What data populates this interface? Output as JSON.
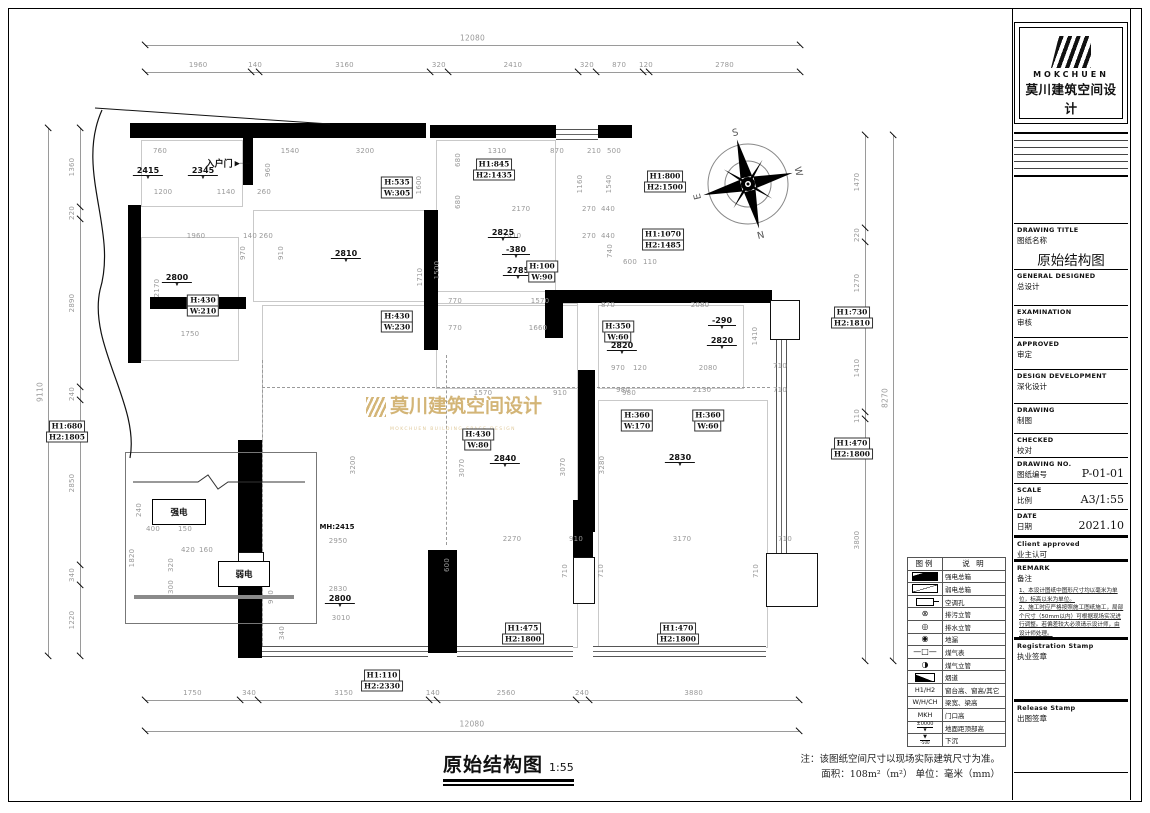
{
  "title_block": {
    "logo_en": "MOKCHUEN",
    "logo_cn": "莫川建筑空间设计",
    "fields": [
      {
        "en": "DRAWING TITLE",
        "cn": "图纸名称",
        "value": "原始结构图",
        "big": true
      },
      {
        "en": "GENERAL  DESIGNED",
        "cn": "总设计",
        "value": ""
      },
      {
        "en": "EXAMINATION",
        "cn": "审核",
        "value": ""
      },
      {
        "en": "APPROVED",
        "cn": "审定",
        "value": ""
      },
      {
        "en": "DESIGN DEVELOPMENT",
        "cn": "深化设计",
        "value": ""
      },
      {
        "en": "DRAWING",
        "cn": "制图",
        "value": ""
      },
      {
        "en": "CHECKED",
        "cn": "校对",
        "value": ""
      },
      {
        "en": "DRAWING NO.",
        "cn": "图纸编号",
        "value": "P-01-01"
      },
      {
        "en": "SCALE",
        "cn": "比例",
        "value": "A3/1:55"
      },
      {
        "en": "DATE",
        "cn": "日期",
        "value": "2021.10"
      },
      {
        "en": "Client approved",
        "cn": "业主认可",
        "value": "",
        "thick": true
      }
    ],
    "remark": {
      "en": "REMARK",
      "cn": "备注",
      "notes": [
        "1、本设计图纸中图形尺寸均以毫米为单位，标高以米为单位。",
        "2、施工时应严格按照施工图纸施工，局部个尺寸（50mm以内）可根据现场实况进行调整。若偏差较大必须请示设计师，由设计师处理。"
      ]
    },
    "stamps": [
      {
        "en": "Registration Stamp",
        "cn": "执业签章"
      },
      {
        "en": "Release Stamp",
        "cn": "出图签章"
      }
    ]
  },
  "legend": {
    "headers": [
      "图例",
      "说  明"
    ],
    "rows": [
      {
        "icon": "solid-bar",
        "label": "强电总箱"
      },
      {
        "icon": "diag-bar",
        "label": "弱电总箱"
      },
      {
        "icon": "kt",
        "label": "空调孔"
      },
      {
        "icon": "circle-cross",
        "sym": "⊗",
        "label": "排污立管"
      },
      {
        "icon": "circle-double",
        "sym": "◎",
        "label": "排水立管"
      },
      {
        "icon": "circle-filled",
        "sym": "◉",
        "label": "地漏"
      },
      {
        "icon": "gas-meter",
        "sym": "—□—",
        "label": "煤气表"
      },
      {
        "icon": "circle-half",
        "sym": "◑",
        "label": "煤气立管"
      },
      {
        "icon": "flue",
        "label": "烟道"
      },
      {
        "icon": "text",
        "icon_text": "H1/H2",
        "label": "窗台高、窗高/其它"
      },
      {
        "icon": "text",
        "icon_text": "W/H/CH",
        "label": "梁宽、梁高"
      },
      {
        "icon": "text",
        "icon_text": "MKH",
        "label": "门口高"
      },
      {
        "icon": "elev",
        "icon_text": "±0000",
        "label": "地面距顶部高"
      },
      {
        "icon": "sunk",
        "icon_text": "-500",
        "label": "下沉"
      }
    ]
  },
  "footer": {
    "title": "原始结构图",
    "scale": "1:55",
    "note1": "注：该图纸空间尺寸以现场实际建筑尺寸为准。",
    "note2": "面积：108m²（m²） 单位：毫米（mm）"
  },
  "plan": {
    "entry_label": "入户门",
    "mh_label": "MH:2415",
    "electric": {
      "strong": "强电",
      "weak": "弱电"
    },
    "watermark": {
      "cn": "莫川建筑空间设计",
      "en": "MOKCHUEN BUILDING SPACE DESIGN"
    },
    "compass": {
      "letters": [
        "S",
        "W",
        "N",
        "E"
      ]
    },
    "totals": {
      "top": "12080",
      "bottom": "12080",
      "left": "9110",
      "right": "8270"
    },
    "chains": {
      "top": {
        "x0": 145,
        "y": 72,
        "scale": 0.05422,
        "values": [
          1960,
          140,
          3160,
          320,
          2410,
          320,
          870,
          120,
          2780
        ]
      },
      "bottom": {
        "x0": 145,
        "y": 700,
        "scale": 0.05422,
        "values": [
          1750,
          340,
          3150,
          140,
          2560,
          240,
          3880
        ]
      },
      "left": {
        "y0": 128,
        "x": 80,
        "scale": 0.05785,
        "values": [
          1360,
          220,
          2890,
          240,
          2850,
          340,
          1220
        ]
      },
      "right": {
        "y0": 135,
        "x": 865,
        "scale": 0.06348,
        "values": [
          1470,
          220,
          1270,
          1410,
          110,
          3800
        ]
      }
    },
    "dim_labels": [
      {
        "t": "760",
        "x": 160,
        "y": 151
      },
      {
        "t": "1540",
        "x": 290,
        "y": 151
      },
      {
        "t": "3200",
        "x": 365,
        "y": 151
      },
      {
        "t": "1310",
        "x": 497,
        "y": 151
      },
      {
        "t": "870",
        "x": 557,
        "y": 151
      },
      {
        "t": "210",
        "x": 594,
        "y": 151
      },
      {
        "t": "500",
        "x": 614,
        "y": 151
      },
      {
        "t": "1200",
        "x": 163,
        "y": 192
      },
      {
        "t": "1140",
        "x": 226,
        "y": 192
      },
      {
        "t": "260",
        "x": 264,
        "y": 192
      },
      {
        "t": "1960",
        "x": 196,
        "y": 236
      },
      {
        "t": "140",
        "x": 250,
        "y": 236
      },
      {
        "t": "260",
        "x": 266,
        "y": 236
      },
      {
        "t": "2170",
        "x": 157,
        "y": 288,
        "r": 1
      },
      {
        "t": "1750",
        "x": 190,
        "y": 334
      },
      {
        "t": "960",
        "x": 268,
        "y": 170,
        "r": 1
      },
      {
        "t": "970",
        "x": 243,
        "y": 253,
        "r": 1
      },
      {
        "t": "910",
        "x": 281,
        "y": 253,
        "r": 1
      },
      {
        "t": "1600",
        "x": 419,
        "y": 185,
        "r": 1
      },
      {
        "t": "1710",
        "x": 420,
        "y": 277,
        "r": 1
      },
      {
        "t": "680",
        "x": 458,
        "y": 160,
        "r": 1
      },
      {
        "t": "680",
        "x": 458,
        "y": 202,
        "r": 1
      },
      {
        "t": "1160",
        "x": 580,
        "y": 184,
        "r": 1
      },
      {
        "t": "1540",
        "x": 609,
        "y": 184,
        "r": 1
      },
      {
        "t": "2170",
        "x": 521,
        "y": 209
      },
      {
        "t": "270",
        "x": 589,
        "y": 209
      },
      {
        "t": "440",
        "x": 608,
        "y": 209
      },
      {
        "t": "2410",
        "x": 512,
        "y": 236
      },
      {
        "t": "270",
        "x": 589,
        "y": 236
      },
      {
        "t": "440",
        "x": 608,
        "y": 236
      },
      {
        "t": "1500",
        "x": 437,
        "y": 270,
        "r": 1
      },
      {
        "t": "740",
        "x": 610,
        "y": 251,
        "r": 1
      },
      {
        "t": "770",
        "x": 455,
        "y": 301
      },
      {
        "t": "1570",
        "x": 540,
        "y": 301
      },
      {
        "t": "600",
        "x": 630,
        "y": 262
      },
      {
        "t": "110",
        "x": 650,
        "y": 262
      },
      {
        "t": "770",
        "x": 455,
        "y": 328
      },
      {
        "t": "1660",
        "x": 538,
        "y": 328
      },
      {
        "t": "870",
        "x": 608,
        "y": 305
      },
      {
        "t": "2080",
        "x": 700,
        "y": 305
      },
      {
        "t": "1410",
        "x": 755,
        "y": 336,
        "r": 1
      },
      {
        "t": "970",
        "x": 618,
        "y": 368
      },
      {
        "t": "120",
        "x": 640,
        "y": 368
      },
      {
        "t": "2080",
        "x": 708,
        "y": 368
      },
      {
        "t": "710",
        "x": 780,
        "y": 366
      },
      {
        "t": "980",
        "x": 623,
        "y": 390
      },
      {
        "t": "2130",
        "x": 702,
        "y": 390
      },
      {
        "t": "710",
        "x": 780,
        "y": 390
      },
      {
        "t": "1570",
        "x": 483,
        "y": 393
      },
      {
        "t": "910",
        "x": 560,
        "y": 393
      },
      {
        "t": "980",
        "x": 629,
        "y": 393
      },
      {
        "t": "3200",
        "x": 353,
        "y": 465,
        "r": 1
      },
      {
        "t": "3070",
        "x": 462,
        "y": 468,
        "r": 1
      },
      {
        "t": "3070",
        "x": 563,
        "y": 467,
        "r": 1
      },
      {
        "t": "3280",
        "x": 602,
        "y": 465,
        "r": 1
      },
      {
        "t": "2270",
        "x": 512,
        "y": 539
      },
      {
        "t": "910",
        "x": 576,
        "y": 539
      },
      {
        "t": "3170",
        "x": 682,
        "y": 539
      },
      {
        "t": "710",
        "x": 785,
        "y": 539
      },
      {
        "t": "600",
        "x": 447,
        "y": 565,
        "r": 1
      },
      {
        "t": "710",
        "x": 565,
        "y": 571,
        "r": 1
      },
      {
        "t": "710",
        "x": 601,
        "y": 571,
        "r": 1
      },
      {
        "t": "710",
        "x": 756,
        "y": 571,
        "r": 1
      },
      {
        "t": "2830",
        "x": 338,
        "y": 589
      },
      {
        "t": "3010",
        "x": 341,
        "y": 618
      },
      {
        "t": "980",
        "x": 271,
        "y": 597,
        "r": 1
      },
      {
        "t": "340",
        "x": 282,
        "y": 633,
        "r": 1
      },
      {
        "t": "2950",
        "x": 338,
        "y": 541
      },
      {
        "t": "240",
        "x": 139,
        "y": 510,
        "r": 1
      },
      {
        "t": "400",
        "x": 153,
        "y": 529
      },
      {
        "t": "150",
        "x": 185,
        "y": 529
      },
      {
        "t": "1820",
        "x": 132,
        "y": 558,
        "r": 1
      },
      {
        "t": "420",
        "x": 188,
        "y": 550
      },
      {
        "t": "160",
        "x": 206,
        "y": 550
      },
      {
        "t": "320",
        "x": 171,
        "y": 565,
        "r": 1
      },
      {
        "t": "300",
        "x": 171,
        "y": 587,
        "r": 1
      }
    ],
    "markers": [
      {
        "t": "2415",
        "x": 148,
        "y": 173
      },
      {
        "t": "2345",
        "x": 203,
        "y": 173
      },
      {
        "t": "2800",
        "x": 177,
        "y": 280
      },
      {
        "t": "2810",
        "x": 346,
        "y": 256
      },
      {
        "t": "2825",
        "x": 503,
        "y": 235
      },
      {
        "t": "-380",
        "x": 516,
        "y": 252
      },
      {
        "t": "2785",
        "x": 518,
        "y": 273
      },
      {
        "t": "2820",
        "x": 622,
        "y": 348
      },
      {
        "t": "-290",
        "x": 722,
        "y": 323
      },
      {
        "t": "2820",
        "x": 722,
        "y": 343
      },
      {
        "t": "2840",
        "x": 505,
        "y": 461
      },
      {
        "t": "2830",
        "x": 680,
        "y": 460
      },
      {
        "t": "2800",
        "x": 340,
        "y": 601
      }
    ],
    "hw_boxes": [
      {
        "l": [
          "H:535",
          "W:305"
        ],
        "x": 397,
        "y": 188
      },
      {
        "l": [
          "H:430",
          "W:210"
        ],
        "x": 203,
        "y": 306
      },
      {
        "l": [
          "H:430",
          "W:230"
        ],
        "x": 397,
        "y": 322
      },
      {
        "l": [
          "H:100",
          "W:90"
        ],
        "x": 542,
        "y": 272
      },
      {
        "l": [
          "H1:845",
          "H2:1435"
        ],
        "x": 494,
        "y": 170
      },
      {
        "l": [
          "H1:800",
          "H2:1500"
        ],
        "x": 665,
        "y": 182
      },
      {
        "l": [
          "H1:1070",
          "H2:1485"
        ],
        "x": 663,
        "y": 240
      },
      {
        "l": [
          "H:350",
          "W:60"
        ],
        "x": 618,
        "y": 332
      },
      {
        "l": [
          "H:360",
          "W:170"
        ],
        "x": 637,
        "y": 421
      },
      {
        "l": [
          "H:360",
          "W:60"
        ],
        "x": 708,
        "y": 421
      },
      {
        "l": [
          "H:430",
          "W:80"
        ],
        "x": 478,
        "y": 440
      },
      {
        "l": [
          "H1:680",
          "H2:1805"
        ],
        "x": 67,
        "y": 432
      },
      {
        "l": [
          "H1:730",
          "H2:1810"
        ],
        "x": 852,
        "y": 318
      },
      {
        "l": [
          "H1:470",
          "H2:1800"
        ],
        "x": 852,
        "y": 449
      },
      {
        "l": [
          "H1:475",
          "H2:1800"
        ],
        "x": 523,
        "y": 634
      },
      {
        "l": [
          "H1:470",
          "H2:1800"
        ],
        "x": 678,
        "y": 634
      },
      {
        "l": [
          "H1:110",
          "H2:2330"
        ],
        "x": 382,
        "y": 681
      }
    ]
  }
}
